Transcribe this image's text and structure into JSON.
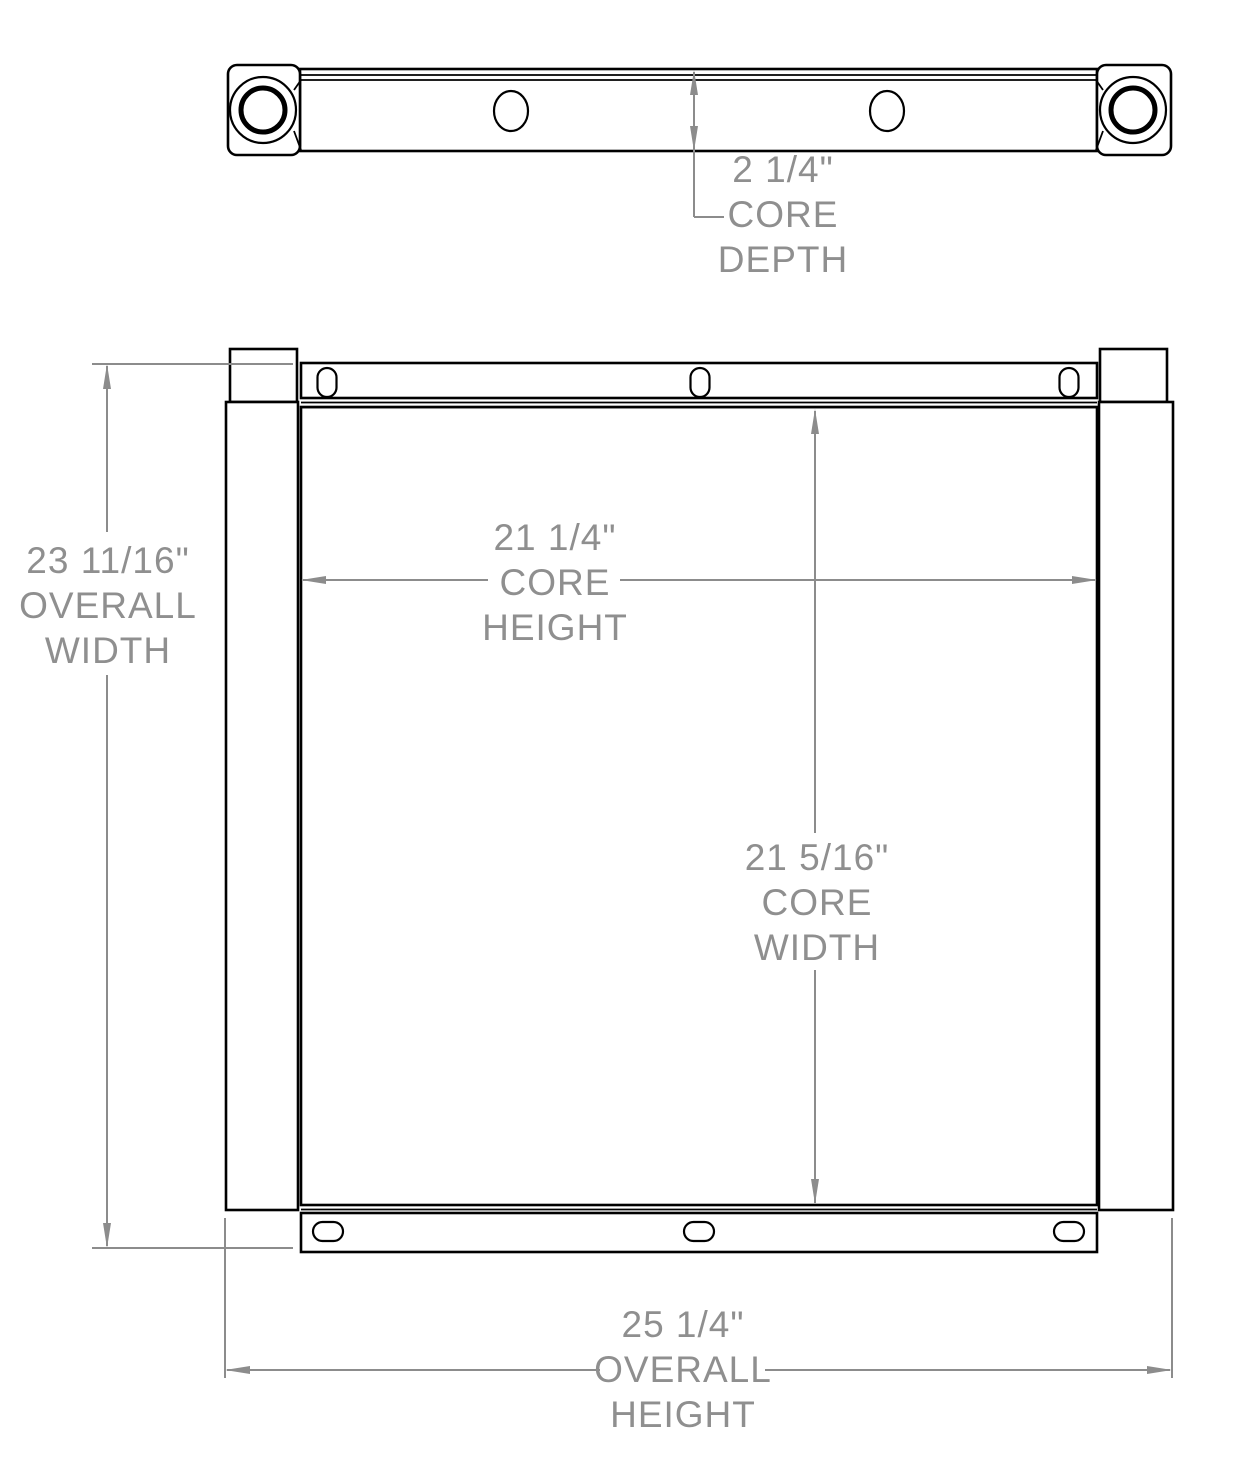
{
  "colors": {
    "outline": "#000000",
    "dimension": "#8c8c8c",
    "dimension_text": "#8f8f8f",
    "background": "#ffffff"
  },
  "dimensions": {
    "core_depth": {
      "value": "2 1/4\"",
      "label": "CORE DEPTH",
      "line1": "2 1/4\"",
      "line2": "CORE",
      "line3": "DEPTH"
    },
    "overall_width": {
      "value": "23 11/16\"",
      "label": "OVERALL WIDTH",
      "line1": "23 11/16\"",
      "line2": "OVERALL",
      "line3": "WIDTH"
    },
    "core_height": {
      "value": "21 1/4\"",
      "label": "CORE HEIGHT",
      "line1": "21 1/4\"",
      "line2": "CORE",
      "line3": "HEIGHT"
    },
    "core_width": {
      "value": "21 5/16\"",
      "label": "CORE WIDTH",
      "line1": "21 5/16\"",
      "line2": "CORE",
      "line3": "WIDTH"
    },
    "overall_height": {
      "value": "25 1/4\"",
      "label": "OVERALL HEIGHT",
      "line1": "25 1/4\"",
      "line2": "OVERALL",
      "line3": "HEIGHT"
    }
  }
}
